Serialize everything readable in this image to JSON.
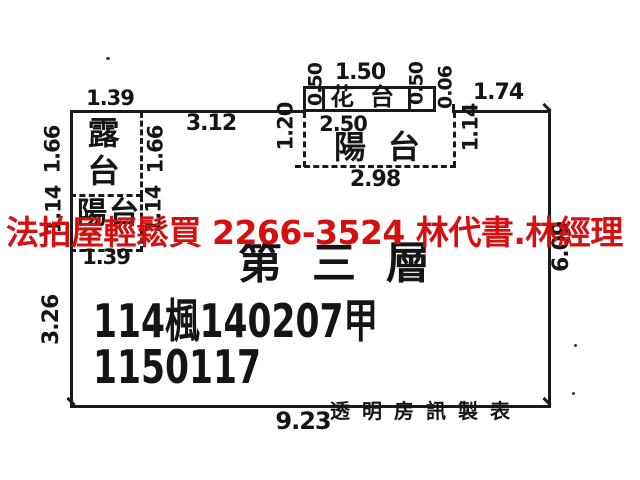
{
  "overlay": {
    "ad_text": "法拍屋輕鬆買  2266-3524  林代書.林經理",
    "ad_color": "#d61010"
  },
  "plan": {
    "rooms": {
      "roof_terrace": "露台",
      "balcony_left": "陽台",
      "flower_bed": "花台",
      "balcony_top": "陽台"
    },
    "floor_label": "第三層",
    "case_number_line1": "114楓140207甲",
    "case_number_line2": "1150117",
    "maker_credit": "透明房訊製表",
    "line_color": "#1a1a1a",
    "dimensions": {
      "terrace_width_top": "1.39",
      "terrace_left_height": "1.66",
      "terrace_right_height": "1.66",
      "top_edge_mid": "3.12",
      "flowerbed_top_width": "1.50",
      "flowerbed_left_depth": "0.50",
      "flowerbed_right_depth": "0.50",
      "step_offset": "0.06",
      "top_edge_right": "1.74",
      "balcony_top_inner_width": "2.50",
      "balcony_top_left_depth": "1.20",
      "balcony_top_right_depth": "1.14",
      "balcony_top_outer_width": "2.98",
      "right_side_height": "6.09",
      "balcony_left_side_a": "1.14",
      "balcony_left_side_b": "1.14",
      "balcony_left_width_bottom": "1.39",
      "left_side_lower_height": "3.26",
      "bottom_width": "9.23"
    }
  }
}
